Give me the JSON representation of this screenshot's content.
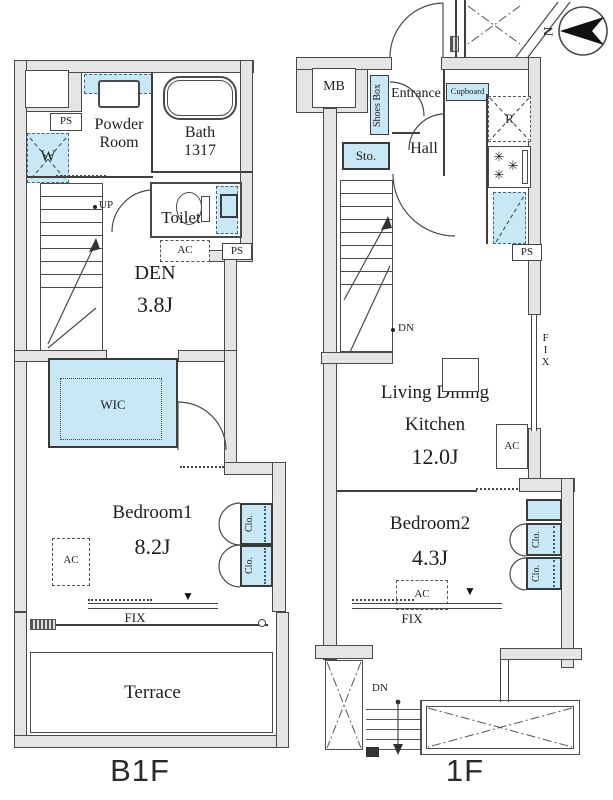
{
  "b1f": {
    "floor_label": "B1F",
    "ps_top": "PS",
    "washer": "W",
    "powder_room": "Powder\nRoom",
    "bath": "Bath\n1317",
    "up": "UP",
    "toilet": "Toilet",
    "ac_den": "AC",
    "ps_side": "PS",
    "den_name": "DEN",
    "den_size": "3.8J",
    "wic": "WIC",
    "bedroom_name": "Bedroom1",
    "bedroom_size": "8.2J",
    "ac_bedroom": "AC",
    "closet_a": "Clo.",
    "closet_b": "Clo.",
    "fix": "FIX",
    "terrace": "Terrace"
  },
  "f1": {
    "floor_label": "1F",
    "mb": "MB",
    "shoes_box": "Shoes Box",
    "entrance": "Entrance",
    "cupboard": "Cupboard",
    "refrigerator": "R",
    "sto": "Sto.",
    "hall": "Hall",
    "ps": "PS",
    "dn_upper": "DN",
    "ldk_line1": "Living Dining",
    "ldk_line2": "Kitchen",
    "ldk_size": "12.0J",
    "fix_right": "FIX",
    "ac_ldk": "AC",
    "bedroom_name": "Bedroom2",
    "bedroom_size": "4.3J",
    "ac_bedroom": "AC",
    "closet_a": "Clo.",
    "closet_b": "Clo.",
    "fix_bottom": "FIX",
    "dn_lower": "DN"
  },
  "compass": {
    "north": "N"
  },
  "icons": {
    "burner": "✳",
    "marker": "▼"
  },
  "colors": {
    "fixture_blue": "#c8e8f6",
    "wall_gray": "#e5e5e5",
    "line": "#3f3f3f"
  }
}
